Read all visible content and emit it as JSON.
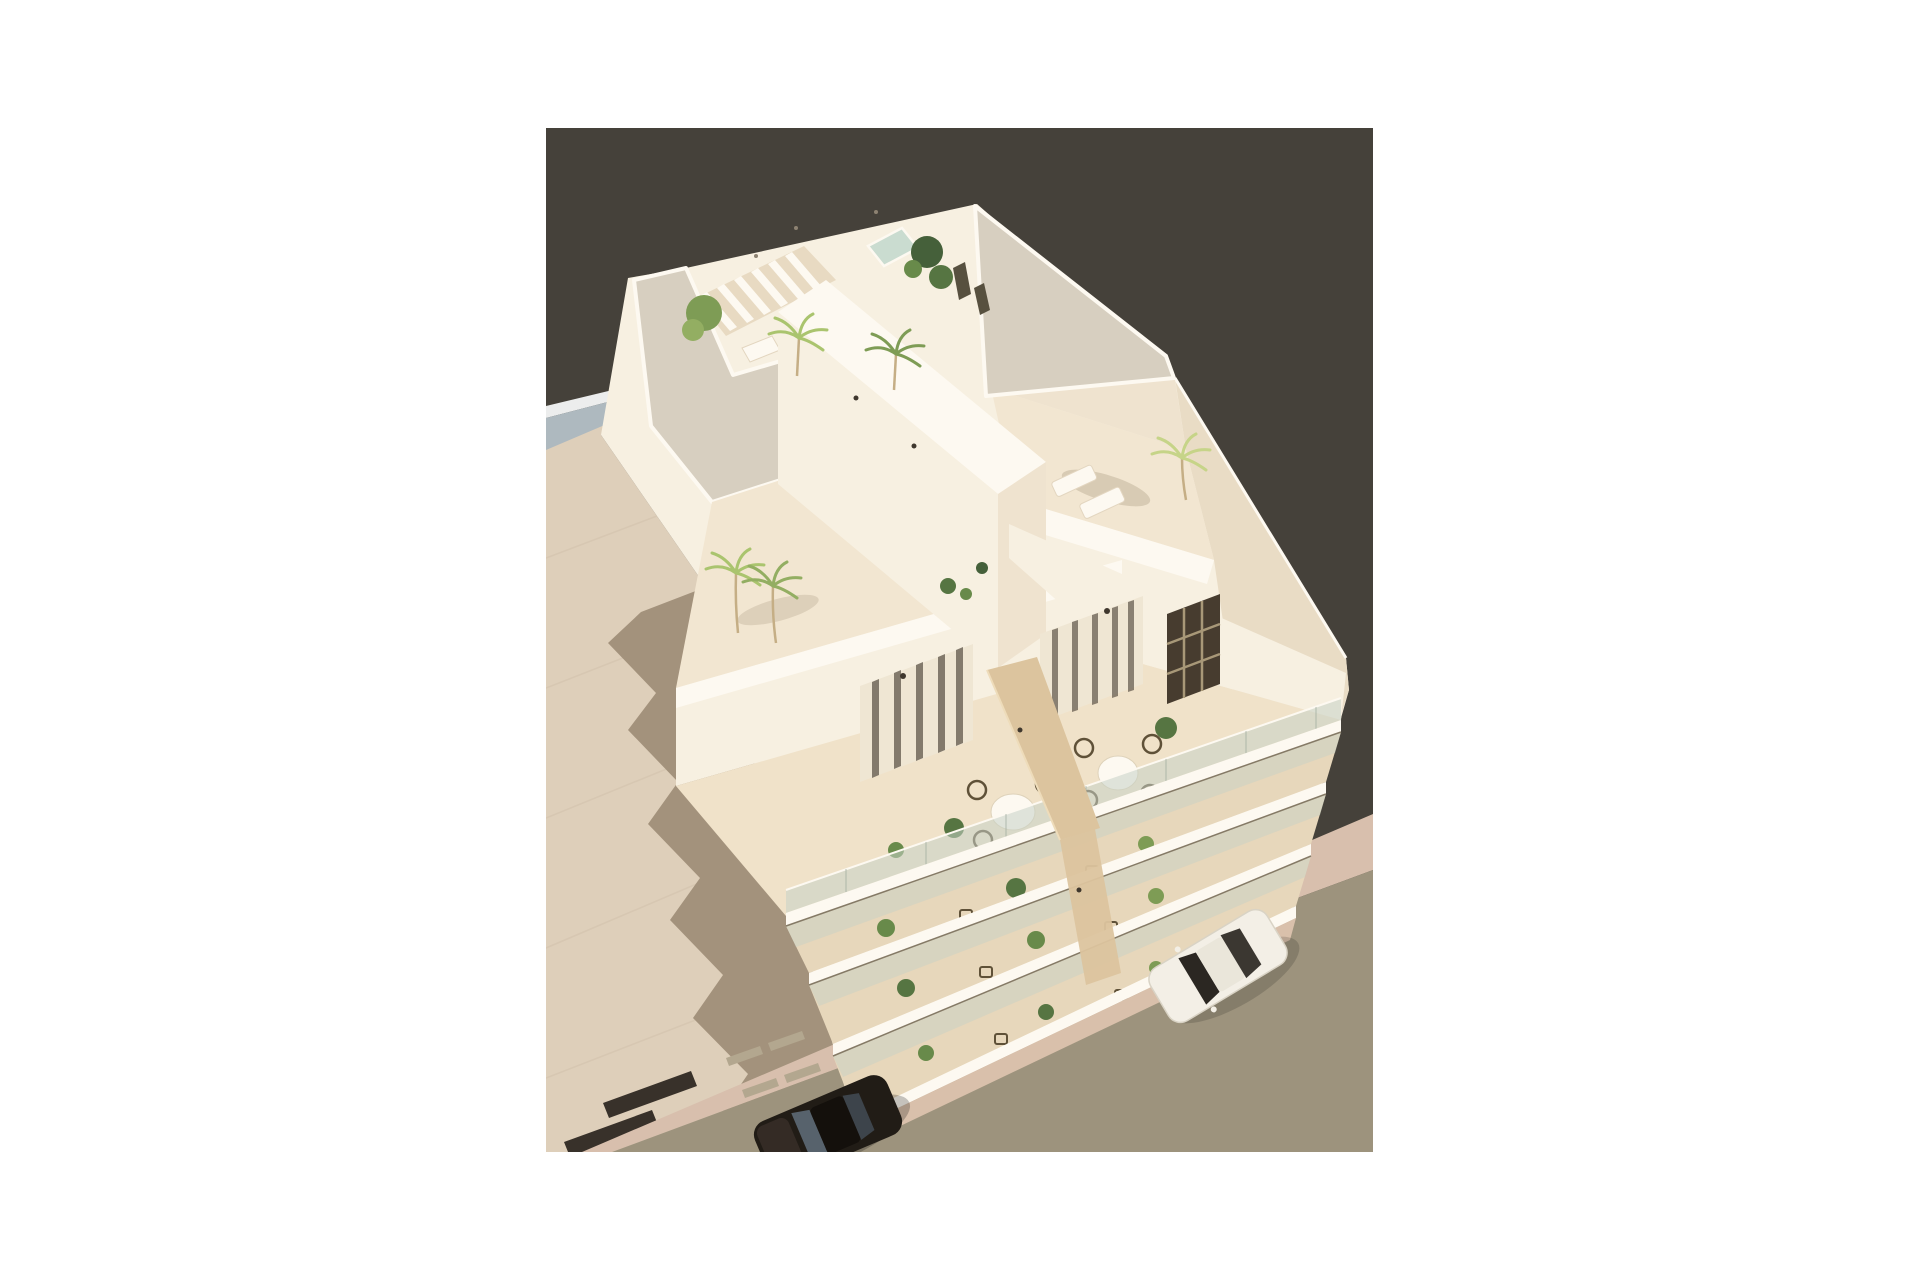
{
  "meta": {
    "title": "Aerial 3D architectural rendering of a modern white apartment building",
    "description": "Bird's-eye render of a cream-white Mediterranean apartment block with gravel roof decks, a small rooftop plunge pool, pergola slats, palm trees, a mid-level terrace with two dining sets split by a wooden privacy divider, stacked balconies with plants, a beige paved plaza casting a jagged building shadow, and a street with a parked white car and a dark car, all on a dark charcoal backdrop inside a white page margin."
  },
  "canvas": {
    "page_width": 1920,
    "page_height": 1280,
    "image_left": 546,
    "image_top": 128,
    "image_width": 827,
    "image_height": 1024
  },
  "colors": {
    "page": "#ffffff",
    "backdrop": "#45413a",
    "plaza": "#decfba",
    "plaza_joint": "#d0c0aa",
    "shadow": "#a3927c",
    "shadow_soft": "#8a7a5e",
    "stripe": "#38312a",
    "neighbor_edge": "#eceded",
    "neighbor_roof": "#aeb9bf",
    "sidewalk": "#d8bfad",
    "road": "#9d937d",
    "wall_bright": "#fdf9f1",
    "wall_lit": "#f7f0e1",
    "wall_mid": "#efe3cf",
    "wall_shade": "#e9dcc5",
    "wall_deep": "#e0d0b6",
    "gravel": "#d7cfc0",
    "roof_floor": "#f2e6d1",
    "terrace_floor": "#f0e2c9",
    "balcony_floor": "#e7d7bb",
    "base_brick": "#d9c0ab",
    "pergola_deck": "#e8dac2",
    "pool": "#cadcd0",
    "glass": "#c7d2c6",
    "glass_dark": "#473c2f",
    "mullion": "#a89878",
    "door_frame": "#efe6d3",
    "door_stripe": "#5f564a",
    "opening": "#57503f",
    "wood": "#dcc49e",
    "wood_edge": "#eedcba",
    "tree_dark": "#45603a",
    "tree_mid": "#567542",
    "tree_leaf": "#688a4a",
    "tree_light": "#7e9c55",
    "palm_mid": "#93ae62",
    "palm_light": "#aac46e",
    "palm_pale": "#c6d488",
    "trunk": "#c5ae85",
    "chair": "#5f5138",
    "lamp": "#3f372d",
    "vent": "#b3a78f",
    "rail_line": "#857a66",
    "car_white": "#f3efe6",
    "car_white_trim": "#d9d3c5",
    "car_roof": "#eae6da",
    "car_glass_dark": "#2b2722",
    "car_dark": "#211c16",
    "car_dark_glass": "#5d6a76"
  },
  "scene": {
    "objects": [
      "white apartment building",
      "gravel roof decks",
      "rooftop plunge pool",
      "pergola slats",
      "palm trees",
      "sun loungers",
      "mid-level terrace dining sets",
      "wooden privacy divider",
      "stacked balconies with plants",
      "glass balustrades",
      "beige plaza with building shadow",
      "pink sidewalk",
      "asphalt street",
      "parked white car",
      "dark car at kerb"
    ]
  }
}
